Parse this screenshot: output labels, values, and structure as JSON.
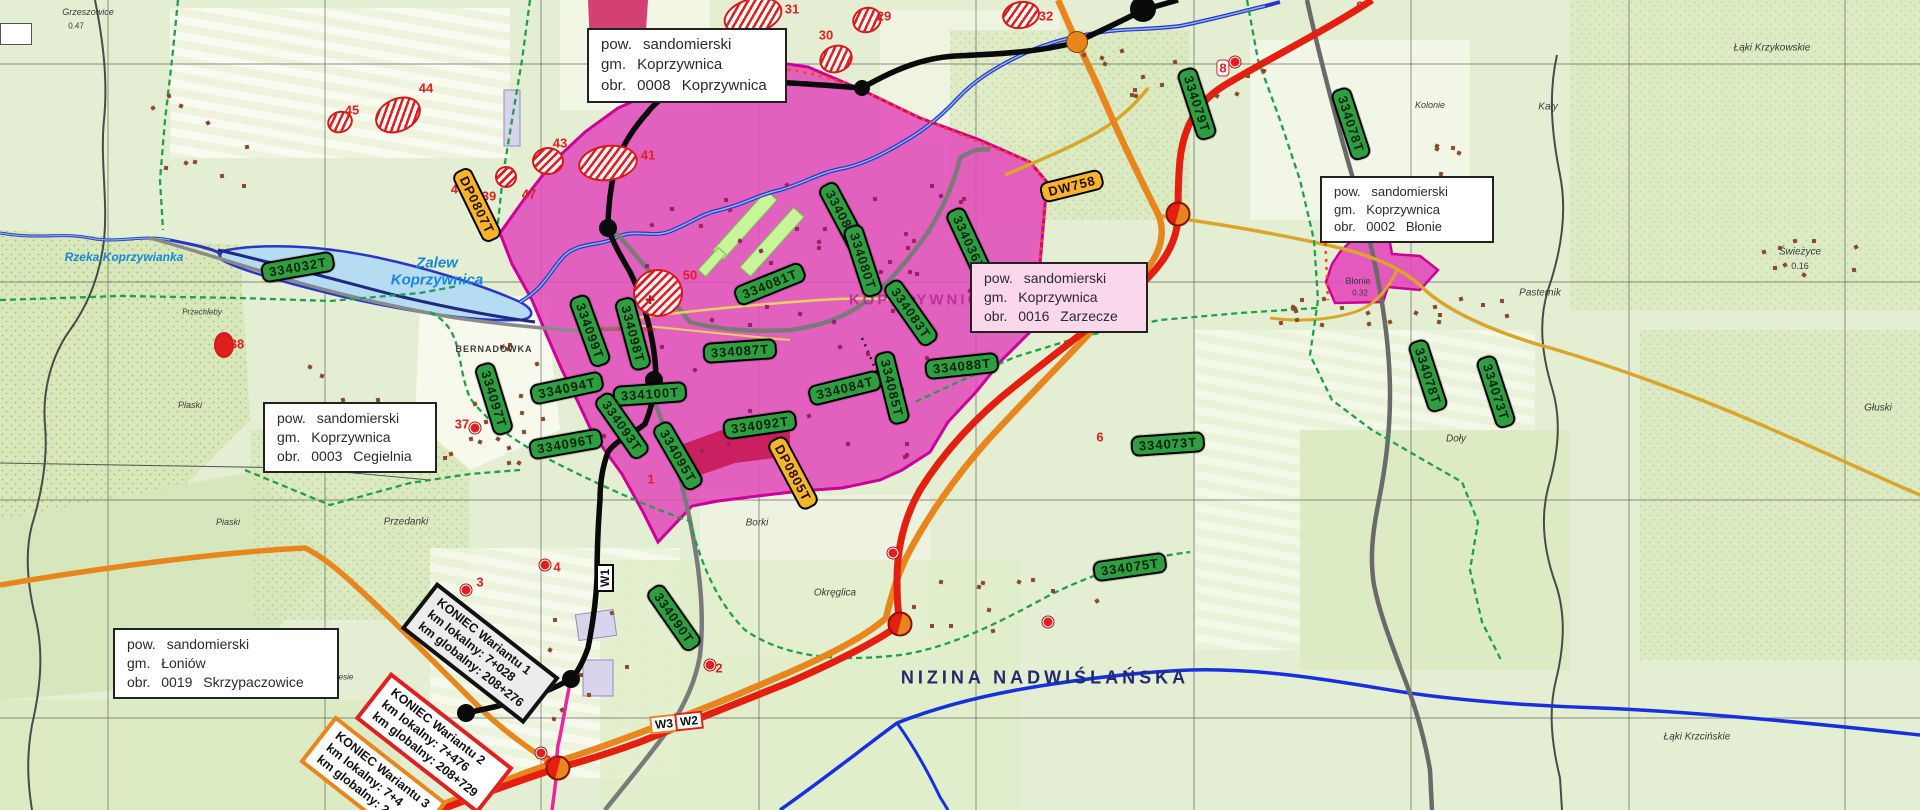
{
  "colors": {
    "label_green": "#2f9e41",
    "label_orange": "#f7b32a",
    "urban_pink": "#e348bb",
    "urban_border": "#cc0099",
    "road_red": "#e51f10",
    "road_orange": "#e8861d",
    "road_black": "#0a0a0a",
    "water_blue": "#2a36c8",
    "hatch_red": "#e02020",
    "city_text": "#b8309c",
    "region_text": "#232a6e"
  },
  "map": {
    "info_boxes": [
      {
        "id": "koprzywnica-0008",
        "lines": [
          "pow. sandomierski",
          "gm. Koprzywnica",
          "obr. 0008 Koprzywnica"
        ],
        "x": 587,
        "y": 28,
        "w": 196,
        "h": 64,
        "bg": "#ffffff",
        "font": 15
      },
      {
        "id": "blonie-0002",
        "lines": [
          "pow. sandomierski",
          "gm. Koprzywnica",
          "obr. 0002 Błonie"
        ],
        "x": 1320,
        "y": 176,
        "w": 170,
        "h": 48,
        "bg": "#ffffff",
        "font": 13
      },
      {
        "id": "zarzecze-0016",
        "lines": [
          "pow. sandomierski",
          "gm. Koprzywnica",
          "obr. 0016 Zarzecze"
        ],
        "x": 970,
        "y": 262,
        "w": 174,
        "h": 62,
        "bg": "#fbd7eb",
        "font": 14
      },
      {
        "id": "cegielnia-0003",
        "lines": [
          "pow. sandomierski",
          "gm. Koprzywnica",
          "obr. 0003 Cegielnia"
        ],
        "x": 263,
        "y": 402,
        "w": 170,
        "h": 66,
        "bg": "#ffffff",
        "font": 14
      },
      {
        "id": "skrzypaczowice-0019",
        "lines": [
          "pow. sandomierski",
          "gm. Łoniów",
          "obr. 0019 Skrzypaczowice"
        ],
        "x": 113,
        "y": 628,
        "w": 222,
        "h": 64,
        "bg": "#ffffff",
        "font": 14
      }
    ],
    "parcel_labels": [
      {
        "text": "334032T",
        "cx": 298,
        "cy": 267,
        "rot": -10
      },
      {
        "text": "334097T",
        "cx": 494,
        "cy": 399,
        "rot": 73
      },
      {
        "text": "334099T",
        "cx": 590,
        "cy": 331,
        "rot": 70
      },
      {
        "text": "334098T",
        "cx": 633,
        "cy": 334,
        "rot": 75
      },
      {
        "text": "334094T",
        "cx": 567,
        "cy": 388,
        "rot": -12
      },
      {
        "text": "334096T",
        "cx": 566,
        "cy": 444,
        "rot": -10
      },
      {
        "text": "334100T",
        "cx": 650,
        "cy": 394,
        "rot": -4
      },
      {
        "text": "334093T",
        "cx": 622,
        "cy": 426,
        "rot": 55
      },
      {
        "text": "334095T",
        "cx": 678,
        "cy": 456,
        "rot": 60
      },
      {
        "text": "334092T",
        "cx": 760,
        "cy": 425,
        "rot": -8
      },
      {
        "text": "334090T",
        "cx": 674,
        "cy": 618,
        "rot": 55
      },
      {
        "text": "334087T",
        "cx": 740,
        "cy": 351,
        "rot": -4
      },
      {
        "text": "334081T",
        "cx": 770,
        "cy": 284,
        "rot": -22
      },
      {
        "text": "334082T",
        "cx": 843,
        "cy": 217,
        "rot": 62
      },
      {
        "text": "334080T",
        "cx": 863,
        "cy": 261,
        "rot": 72
      },
      {
        "text": "334083T",
        "cx": 911,
        "cy": 313,
        "rot": 55
      },
      {
        "text": "334084T",
        "cx": 845,
        "cy": 388,
        "rot": -14
      },
      {
        "text": "334085T",
        "cx": 892,
        "cy": 388,
        "rot": 76
      },
      {
        "text": "334088T",
        "cx": 962,
        "cy": 366,
        "rot": -6
      },
      {
        "text": "334036T",
        "cx": 969,
        "cy": 243,
        "rot": 65
      },
      {
        "text": "334075T",
        "cx": 1130,
        "cy": 567,
        "rot": -8
      },
      {
        "text": "334079T",
        "cx": 1197,
        "cy": 104,
        "rot": 72
      },
      {
        "text": "334078T",
        "cx": 1351,
        "cy": 124,
        "rot": 72
      },
      {
        "text": "334078T",
        "cx": 1428,
        "cy": 376,
        "rot": 72
      },
      {
        "text": "334073T",
        "cx": 1496,
        "cy": 392,
        "rot": 72
      },
      {
        "text": "334073T",
        "cx": 1168,
        "cy": 444,
        "rot": -4
      }
    ],
    "road_labels": [
      {
        "text": "DP0807T",
        "cx": 477,
        "cy": 205,
        "rot": 64
      },
      {
        "text": "DW758",
        "cx": 1072,
        "cy": 186,
        "rot": -14
      },
      {
        "text": "DP0805T",
        "cx": 793,
        "cy": 473,
        "rot": 62
      }
    ],
    "variant_markers": [
      {
        "text": "W1",
        "cx": 605,
        "cy": 578,
        "rot": -90,
        "border": "#0a0a0a"
      },
      {
        "text": "W3",
        "cx": 664,
        "cy": 724,
        "rot": -6,
        "border": "#e8861d"
      },
      {
        "text": "W2",
        "cx": 689,
        "cy": 721,
        "rot": -6,
        "border": "#e51f10"
      }
    ],
    "variant_end_boxes": [
      {
        "lines": [
          "KONIEC Wariantu 1",
          "km lokalny: 7+028",
          "km globalny: 208+276"
        ],
        "cx": 480,
        "cy": 653,
        "rot": 38,
        "border": "#111111",
        "bg": "#ececec"
      },
      {
        "lines": [
          "KONIEC Wariantu 2",
          "km lokalny: 7+476",
          "km globalny: 208+729"
        ],
        "cx": 434,
        "cy": 743,
        "rot": 38,
        "border": "#e02020",
        "bg": "#ffffff"
      },
      {
        "lines": [
          "KONIEC Wariantu 3",
          "km lokalny: 7+4",
          "km globalny: 2"
        ],
        "cx": 373,
        "cy": 782,
        "rot": 38,
        "border": "#e8861d",
        "bg": "#ffffff"
      }
    ],
    "numbered_areas": [
      {
        "cx": 753,
        "cy": 16,
        "rx": 28,
        "ry": 16,
        "rot": -15
      },
      {
        "cx": 836,
        "cy": 59,
        "rx": 15,
        "ry": 12,
        "rot": -20
      },
      {
        "cx": 867,
        "cy": 20,
        "rx": 13,
        "ry": 11,
        "rot": -20
      },
      {
        "cx": 1021,
        "cy": 15,
        "rx": 17,
        "ry": 12,
        "rot": -10
      },
      {
        "cx": 398,
        "cy": 115,
        "rx": 22,
        "ry": 15,
        "rot": -25
      },
      {
        "cx": 340,
        "cy": 122,
        "rx": 11,
        "ry": 9,
        "rot": -20
      },
      {
        "cx": 548,
        "cy": 161,
        "rx": 14,
        "ry": 12,
        "rot": 0
      },
      {
        "cx": 608,
        "cy": 163,
        "rx": 28,
        "ry": 16,
        "rot": -8
      },
      {
        "cx": 506,
        "cy": 177,
        "rx": 9,
        "ry": 9,
        "rot": 0
      },
      {
        "cx": 658,
        "cy": 293,
        "rx": 23,
        "ry": 22,
        "rot": 0
      },
      {
        "cx": 224,
        "cy": 345,
        "rx": 8,
        "ry": 11,
        "rot": 0,
        "solid": true
      }
    ],
    "numbered_points": [
      {
        "n": "31",
        "x": 792,
        "y": 9
      },
      {
        "n": "30",
        "x": 826,
        "y": 35
      },
      {
        "n": "29",
        "x": 884,
        "y": 16
      },
      {
        "n": "32",
        "x": 1046,
        "y": 16
      },
      {
        "n": "44",
        "x": 426,
        "y": 88
      },
      {
        "n": "45",
        "x": 352,
        "y": 110
      },
      {
        "n": "43",
        "x": 560,
        "y": 143
      },
      {
        "n": "41",
        "x": 648,
        "y": 155
      },
      {
        "n": "47",
        "x": 529,
        "y": 194
      },
      {
        "n": "40",
        "x": 458,
        "y": 189
      },
      {
        "n": "39",
        "x": 489,
        "y": 196
      },
      {
        "n": "38",
        "x": 237,
        "y": 344
      },
      {
        "n": "50",
        "x": 690,
        "y": 275
      },
      {
        "n": "37",
        "x": 462,
        "y": 424
      },
      {
        "n": "1",
        "x": 651,
        "y": 479
      },
      {
        "n": "4",
        "x": 557,
        "y": 567
      },
      {
        "n": "3",
        "x": 480,
        "y": 582
      },
      {
        "n": "2",
        "x": 540,
        "y": 673
      },
      {
        "n": "2",
        "x": 719,
        "y": 668
      },
      {
        "n": "21",
        "x": 551,
        "y": 760
      },
      {
        "n": "6",
        "x": 1100,
        "y": 437
      },
      {
        "n": "8",
        "x": 1223,
        "y": 68,
        "badge": true
      },
      {
        "n": "9",
        "x": 1360,
        "y": 6
      }
    ],
    "point_markers": [
      {
        "x": 545,
        "y": 565
      },
      {
        "x": 466,
        "y": 590
      },
      {
        "x": 528,
        "y": 667
      },
      {
        "x": 710,
        "y": 665
      },
      {
        "x": 541,
        "y": 753
      },
      {
        "x": 1235,
        "y": 62
      },
      {
        "x": 475,
        "y": 428
      },
      {
        "x": 893,
        "y": 553
      },
      {
        "x": 473,
        "y": 196
      },
      {
        "x": 1048,
        "y": 622
      }
    ],
    "route_nodes": [
      {
        "x": 1143,
        "y": 9,
        "r": 13
      },
      {
        "x": 862,
        "y": 88,
        "r": 8
      },
      {
        "x": 705,
        "y": 80,
        "r": 8
      },
      {
        "x": 608,
        "y": 228,
        "r": 9
      },
      {
        "x": 654,
        "y": 380,
        "r": 9
      },
      {
        "x": 571,
        "y": 679,
        "r": 9
      },
      {
        "x": 466,
        "y": 713,
        "r": 9
      }
    ],
    "junction_markers": [
      {
        "x": 1178,
        "y": 214
      },
      {
        "x": 900,
        "y": 624
      },
      {
        "x": 558,
        "y": 768
      }
    ],
    "orange_node": {
      "x": 1077,
      "y": 42,
      "r": 10
    },
    "water_labels": [
      {
        "text": "Zalew",
        "x": 437,
        "y": 263,
        "size": 15
      },
      {
        "text": "Koprzywnica",
        "x": 437,
        "y": 280,
        "size": 15
      },
      {
        "text": "Rzeka Koprzywianka",
        "x": 124,
        "y": 257,
        "size": 12
      }
    ],
    "place_labels": [
      {
        "text": "Grzeszowice",
        "x": 88,
        "y": 12,
        "size": 9,
        "it": 1
      },
      {
        "text": "0.47",
        "x": 76,
        "y": 26,
        "size": 8
      },
      {
        "text": "Przechleby",
        "x": 202,
        "y": 312,
        "size": 8,
        "it": 1
      },
      {
        "text": "Piaski",
        "x": 190,
        "y": 405,
        "size": 9,
        "it": 1
      },
      {
        "text": "Piaski",
        "x": 228,
        "y": 522,
        "size": 9,
        "it": 1
      },
      {
        "text": "Przedanki",
        "x": 406,
        "y": 522,
        "size": 10,
        "it": 1
      },
      {
        "text": "Podlesie",
        "x": 338,
        "y": 677,
        "size": 8,
        "it": 1
      },
      {
        "text": "BERNADÓWKA",
        "x": 494,
        "y": 349,
        "size": 9,
        "bold": 1
      },
      {
        "text": "Borki",
        "x": 757,
        "y": 523,
        "size": 10,
        "it": 1
      },
      {
        "text": "Okręglica",
        "x": 835,
        "y": 593,
        "size": 10,
        "it": 1
      },
      {
        "text": "Kolonie",
        "x": 1430,
        "y": 105,
        "size": 9,
        "it": 1
      },
      {
        "text": "Kały",
        "x": 1548,
        "y": 107,
        "size": 10,
        "it": 1
      },
      {
        "text": "Łąki Krzykowskie",
        "x": 1772,
        "y": 48,
        "size": 10,
        "it": 1
      },
      {
        "text": "Świeżyce",
        "x": 1800,
        "y": 252,
        "size": 10,
        "it": 1
      },
      {
        "text": "0.16",
        "x": 1800,
        "y": 266,
        "size": 9
      },
      {
        "text": "Pasternik",
        "x": 1540,
        "y": 293,
        "size": 10,
        "it": 1
      },
      {
        "text": "Głuski",
        "x": 1878,
        "y": 408,
        "size": 10,
        "it": 1
      },
      {
        "text": "Doły",
        "x": 1456,
        "y": 439,
        "size": 10,
        "it": 1
      },
      {
        "text": "Łąki Krzcińskie",
        "x": 1697,
        "y": 737,
        "size": 10,
        "it": 1
      },
      {
        "text": "Błonie",
        "x": 1358,
        "y": 281,
        "size": 9
      },
      {
        "text": "0.32",
        "x": 1360,
        "y": 293,
        "size": 8
      },
      {
        "text": "Kościół Św. Floriana",
        "x": 628,
        "y": 330,
        "size": 6,
        "color": "#cc2020"
      }
    ],
    "city_label": {
      "text": "KOPRZYWNICA",
      "x": 922,
      "y": 300,
      "size": 15
    },
    "region_label": {
      "text": "NIZINA NADWIŚLAŃSKA",
      "x": 1045,
      "y": 678,
      "size": 18
    }
  }
}
